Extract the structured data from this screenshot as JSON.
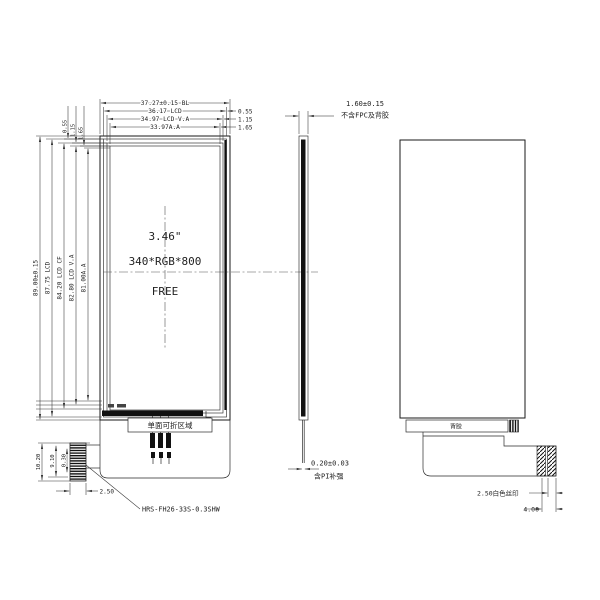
{
  "front_view": {
    "top_dims": [
      "37.27±0.15 BL",
      "36.17 LCD",
      "34.97 LCD V.A",
      "33.97A.A"
    ],
    "right_inset_dims": [
      "0.55",
      "1.15",
      "1.65"
    ],
    "left_inset_dims": [
      "0.55",
      "1.15",
      "1.65"
    ],
    "height_dims": [
      "89.00±0.15",
      "87.75 LCD",
      "84.20 LCD CF",
      "82.80 LCD V.A",
      "81.00A.A"
    ],
    "display": {
      "size": "3.46\"",
      "resolution": "340*RGB*800",
      "mode": "FREE"
    },
    "fold_area_label": "单面可折区域",
    "connector": {
      "height_dims": [
        "10.20",
        "9.10",
        "0.30"
      ],
      "width_dim": "2.50",
      "part_number": "HRS-FH26-33S-0.3SHW"
    }
  },
  "side_view": {
    "thickness_dim": "1.60±0.15",
    "thickness_note": "不含FPC及背胶",
    "fpc_dim": "0.20±0.03",
    "fpc_note": "含PI补强"
  },
  "back_view": {
    "adhesive_label": "背胶",
    "silkscreen_dim": "2.50白色丝印",
    "connector_width_dim": "4.00"
  }
}
